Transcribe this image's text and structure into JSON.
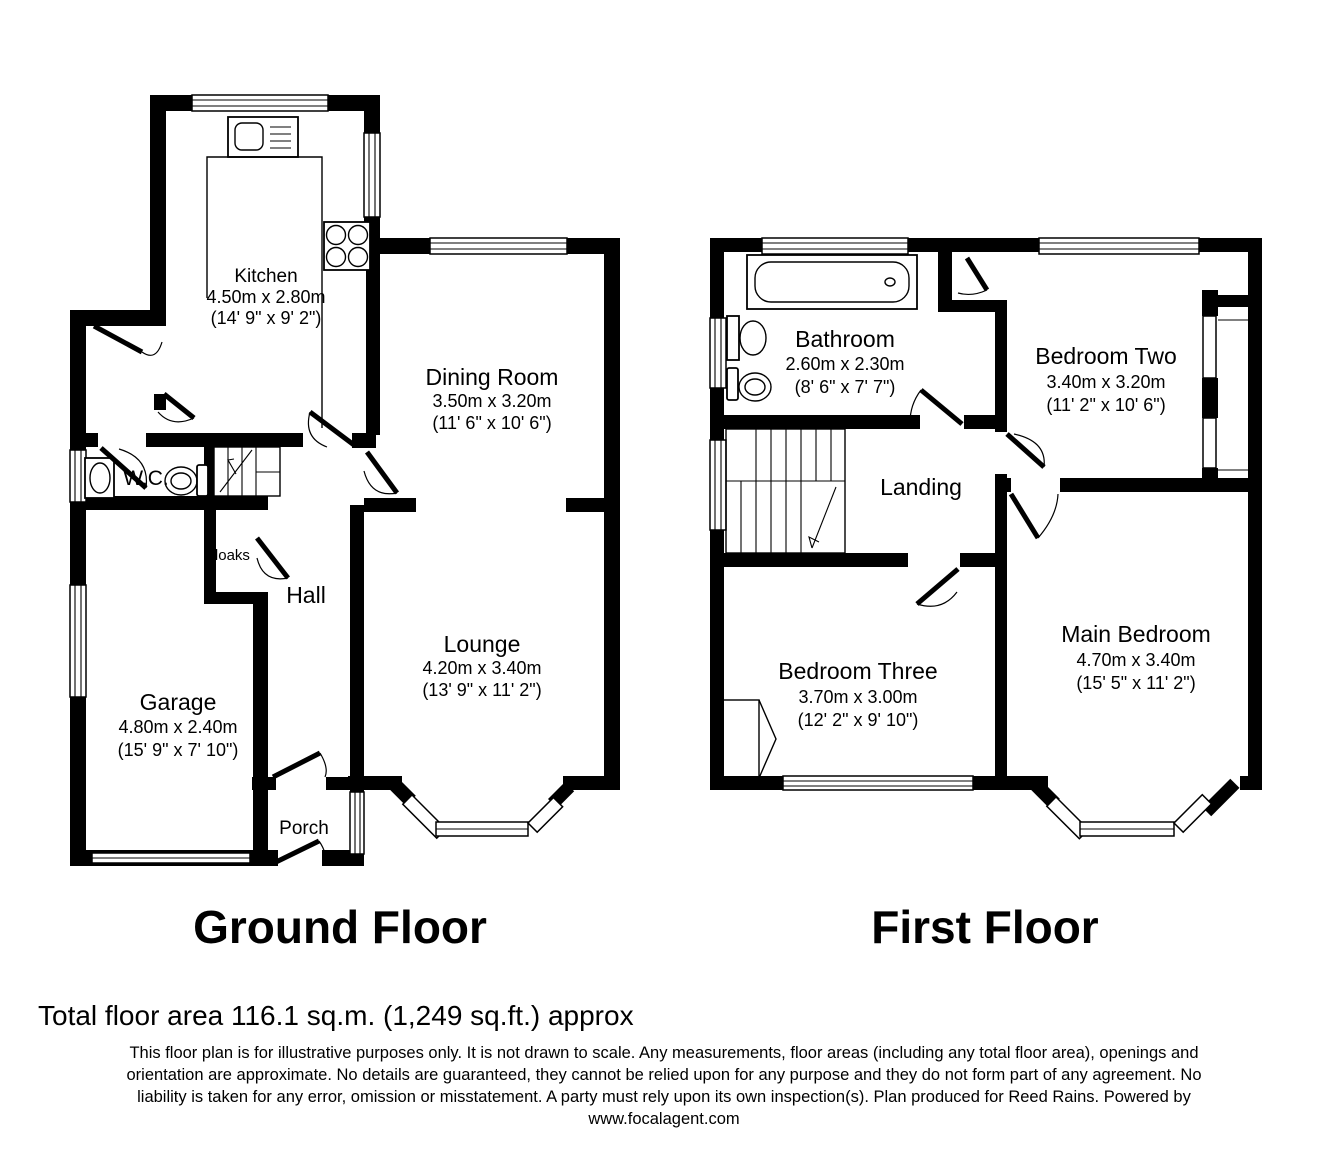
{
  "colors": {
    "line": "#000000",
    "background": "#ffffff"
  },
  "gf": {
    "title": "Ground Floor",
    "rooms": {
      "kitchen": {
        "name": "Kitchen",
        "metric": "4.50m x 2.80m",
        "imperial": "(14' 9\" x 9' 2\")"
      },
      "dining_room": {
        "name": "Dining Room",
        "metric": "3.50m x 3.20m",
        "imperial": "(11' 6\" x 10' 6\")"
      },
      "lounge": {
        "name": "Lounge",
        "metric": "4.20m x 3.40m",
        "imperial": "(13' 9\" x 11' 2\")"
      },
      "garage": {
        "name": "Garage",
        "metric": "4.80m x 2.40m",
        "imperial": "(15' 9\" x 7' 10\")"
      },
      "wc": {
        "name": "W.C."
      },
      "cloaks": {
        "name": "Cloaks"
      },
      "hall": {
        "name": "Hall"
      },
      "porch": {
        "name": "Porch"
      }
    }
  },
  "ff": {
    "title": "First Floor",
    "rooms": {
      "bathroom": {
        "name": "Bathroom",
        "metric": "2.60m x 2.30m",
        "imperial": "(8' 6\" x 7' 7\")"
      },
      "bedroom_two": {
        "name": "Bedroom Two",
        "metric": "3.40m x 3.20m",
        "imperial": "(11' 2\" x 10' 6\")"
      },
      "landing": {
        "name": "Landing"
      },
      "bedroom_three": {
        "name": "Bedroom Three",
        "metric": "3.70m x 3.00m",
        "imperial": "(12' 2\" x 9' 10\")"
      },
      "main_bedroom": {
        "name": "Main Bedroom",
        "metric": "4.70m x 3.40m",
        "imperial": "(15' 5\" x 11' 2\")"
      }
    }
  },
  "footer": {
    "total_area": "Total floor area 116.1 sq.m. (1,249 sq.ft.) approx",
    "disclaimer_lines": [
      "This floor plan is for illustrative purposes only. It is not drawn to scale. Any measurements, floor areas (including any total floor area), openings and",
      "orientation are approximate. No details are guaranteed, they cannot be relied upon for any purpose and they do not form part of any agreement. No",
      "liability is taken for any error, omission or misstatement. A party must rely upon its own inspection(s). Plan produced for Reed Rains. Powered by",
      "www.focalagent.com"
    ]
  }
}
